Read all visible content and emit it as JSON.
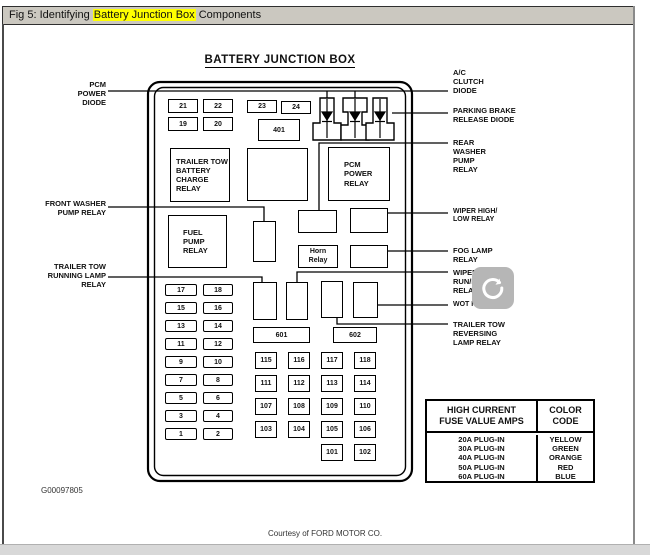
{
  "window": {
    "title_prefix": "Fig 5: Identifying ",
    "title_highlight": "Battery Junction Box",
    "title_suffix": " Components"
  },
  "diagram": {
    "title": "BATTERY JUNCTION BOX",
    "footer_code": "G00097805",
    "courtesy": "Courtesy of FORD MOTOR CO.",
    "labels": {
      "left": [
        {
          "text": "PCM\nPOWER\nDIODE"
        },
        {
          "text": "FRONT WASHER\nPUMP RELAY"
        },
        {
          "text": "TRAILER TOW\nRUNNING LAMP\nRELAY"
        }
      ],
      "right": [
        {
          "text": "A/C\nCLUTCH\nDIODE"
        },
        {
          "text": "PARKING BRAKE\nRELEASE DIODE"
        },
        {
          "text": "REAR\nWASHER\nPUMP\nRELAY"
        },
        {
          "text": "WIPER HIGH/\nLOW RELAY"
        },
        {
          "text": "FOG LAMP\nRELAY"
        },
        {
          "text": "WIPER\nRUN/PARK\nRELAY"
        },
        {
          "text": "WOT RELAY"
        },
        {
          "text": "TRAILER TOW\nREVERSING\nLAMP RELAY"
        }
      ]
    },
    "boxes": {
      "trailer_tow_battery": "TRAILER TOW\nBATTERY\nCHARGE\nRELAY",
      "pcm_power": "PCM\nPOWER\nRELAY",
      "fuel_pump": "FUEL\nPUMP\nRELAY",
      "horn": "Horn\nRelay"
    },
    "fuses": {
      "top_row": [
        "21",
        "22",
        "23",
        "24"
      ],
      "second_row": [
        "19",
        "20"
      ],
      "fuse_401": "401",
      "strip_601": "601",
      "strip_602": "602",
      "left_pairs": [
        "17",
        "18",
        "15",
        "16",
        "13",
        "14",
        "11",
        "12",
        "9",
        "10",
        "7",
        "8",
        "5",
        "6",
        "3",
        "4",
        "1",
        "2"
      ],
      "squares": [
        "115",
        "116",
        "117",
        "118",
        "111",
        "112",
        "113",
        "114",
        "107",
        "108",
        "109",
        "110",
        "103",
        "104",
        "105",
        "106",
        "101",
        "102"
      ]
    }
  },
  "table": {
    "headers": [
      "HIGH CURRENT\nFUSE VALUE AMPS",
      "COLOR\nCODE"
    ],
    "rows": [
      [
        "20A PLUG-IN",
        "YELLOW"
      ],
      [
        "30A PLUG-IN",
        "GREEN"
      ],
      [
        "40A PLUG-IN",
        "ORANGE"
      ],
      [
        "50A PLUG-IN",
        "RED"
      ],
      [
        "60A PLUG-IN",
        "BLUE"
      ]
    ]
  },
  "overlay": {
    "spinner_icon": "loading-refresh"
  },
  "colors": {
    "titlebar_bg": "#cbc8c0",
    "highlight": "#ffff00",
    "line": "#000000",
    "spinner_bg": "#b6b6b6",
    "bottom_strip": "#d8d8d8"
  }
}
